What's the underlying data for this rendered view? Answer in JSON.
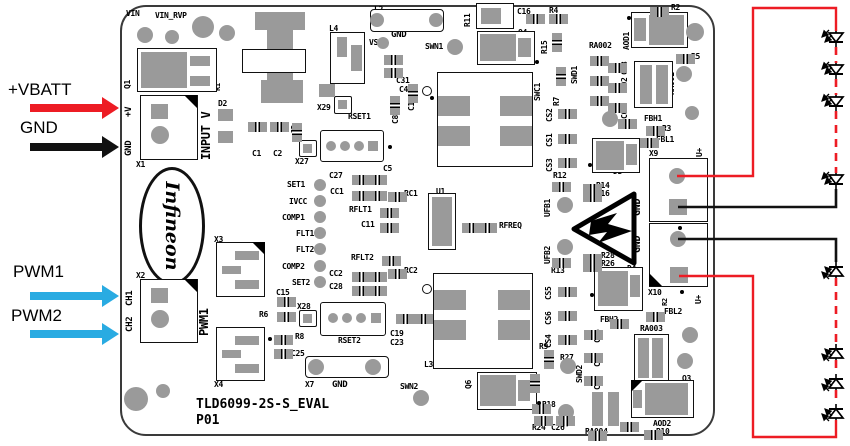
{
  "colors": {
    "supply_red": "#ed1c24",
    "return_black": "#111111",
    "pwm_blue": "#29abe2",
    "pad_gray": "#9a9a9a",
    "board_border": "#3a3a3a"
  },
  "inputs": {
    "vbatt_label": "+VBATT",
    "gnd_label": "GND",
    "pwm1_label": "PWM1",
    "pwm2_label": "PWM2"
  },
  "board": {
    "title": "TLD6099-2S-S_EVAL",
    "revision": "P01",
    "logo_text": "Infineon",
    "labels": [
      {
        "t": "VIN",
        "x": 126,
        "y": 10
      },
      {
        "t": "VIN_RVP",
        "x": 155,
        "y": 12
      },
      {
        "t": "L2",
        "x": 374,
        "y": 6
      },
      {
        "t": "X12",
        "x": 380,
        "y": 19
      },
      {
        "t": "GND",
        "x": 391,
        "y": 31,
        "s": 9
      },
      {
        "t": "VS",
        "x": 369,
        "y": 39
      },
      {
        "t": "SWN1",
        "x": 425,
        "y": 43
      },
      {
        "t": "R11",
        "x": 464,
        "y": 27,
        "v": 1
      },
      {
        "t": "C16",
        "x": 517,
        "y": 8
      },
      {
        "t": "R4",
        "x": 549,
        "y": 7
      },
      {
        "t": "Q4",
        "x": 518,
        "y": 29
      },
      {
        "t": "R15",
        "x": 541,
        "y": 54,
        "v": 1
      },
      {
        "t": "L4",
        "x": 329,
        "y": 25
      },
      {
        "t": "X29",
        "x": 317,
        "y": 104
      },
      {
        "t": "C31",
        "x": 396,
        "y": 77
      },
      {
        "t": "C4",
        "x": 399,
        "y": 86
      },
      {
        "t": "C13",
        "x": 408,
        "y": 111,
        "v": 1
      },
      {
        "t": "C8",
        "x": 392,
        "y": 124,
        "v": 1
      },
      {
        "t": "C3",
        "x": 291,
        "y": 134,
        "v": 1
      },
      {
        "t": "D2",
        "x": 218,
        "y": 100
      },
      {
        "t": "C1",
        "x": 252,
        "y": 150
      },
      {
        "t": "C2",
        "x": 273,
        "y": 150
      },
      {
        "t": "X27",
        "x": 295,
        "y": 158
      },
      {
        "t": "RSET1",
        "x": 348,
        "y": 113
      },
      {
        "t": "C5",
        "x": 383,
        "y": 165
      },
      {
        "t": "RA002",
        "x": 589,
        "y": 42
      },
      {
        "t": "SWD1",
        "x": 571,
        "y": 84,
        "v": 1
      },
      {
        "t": "SWC1",
        "x": 534,
        "y": 101,
        "v": 1
      },
      {
        "t": "R7",
        "x": 553,
        "y": 106,
        "v": 1
      },
      {
        "t": "R2",
        "x": 671,
        "y": 4
      },
      {
        "t": "AOD1",
        "x": 623,
        "y": 50,
        "v": 1
      },
      {
        "t": "R5",
        "x": 691,
        "y": 53
      },
      {
        "t": "RA001",
        "x": 668,
        "y": 95,
        "v": 1
      },
      {
        "t": "C03",
        "x": 621,
        "y": 75,
        "v": 1
      },
      {
        "t": "C02",
        "x": 621,
        "y": 91,
        "v": 1
      },
      {
        "t": "C01",
        "x": 621,
        "y": 119,
        "v": 1
      },
      {
        "t": "FBH1",
        "x": 644,
        "y": 115
      },
      {
        "t": "R3",
        "x": 662,
        "y": 125
      },
      {
        "t": "FBL1",
        "x": 656,
        "y": 136
      },
      {
        "t": "CS2",
        "x": 546,
        "y": 122,
        "v": 1
      },
      {
        "t": "CS1",
        "x": 546,
        "y": 147,
        "v": 1
      },
      {
        "t": "CS3",
        "x": 546,
        "y": 172,
        "v": 1
      },
      {
        "t": "L1",
        "x": 514,
        "y": 160
      },
      {
        "t": "R12",
        "x": 553,
        "y": 172
      },
      {
        "t": "R14",
        "x": 596,
        "y": 182
      },
      {
        "t": "R16",
        "x": 596,
        "y": 190
      },
      {
        "t": "UFB1",
        "x": 544,
        "y": 217,
        "v": 1
      },
      {
        "t": "UFB2",
        "x": 544,
        "y": 264,
        "v": 1
      },
      {
        "t": "R28",
        "x": 601,
        "y": 252
      },
      {
        "t": "R26",
        "x": 601,
        "y": 260
      },
      {
        "t": "R13",
        "x": 551,
        "y": 267
      },
      {
        "t": "D3",
        "x": 613,
        "y": 168
      },
      {
        "t": "D4",
        "x": 627,
        "y": 265
      },
      {
        "t": "X9",
        "x": 649,
        "y": 150
      },
      {
        "t": "U+",
        "x": 696,
        "y": 157,
        "v": 1
      },
      {
        "t": "GND",
        "x": 633,
        "y": 216,
        "v": 1,
        "s": 10
      },
      {
        "t": "GND",
        "x": 633,
        "y": 253,
        "v": 1,
        "s": 10
      },
      {
        "t": "X10",
        "x": 648,
        "y": 289
      },
      {
        "t": "R2",
        "x": 662,
        "y": 306,
        "v": 1,
        "s": 7
      },
      {
        "t": "U+",
        "x": 695,
        "y": 304,
        "v": 1
      },
      {
        "t": "SET1",
        "x": 287,
        "y": 181
      },
      {
        "t": "IVCC",
        "x": 289,
        "y": 198
      },
      {
        "t": "COMP1",
        "x": 282,
        "y": 214
      },
      {
        "t": "FLT1",
        "x": 296,
        "y": 230
      },
      {
        "t": "FLT2",
        "x": 296,
        "y": 246
      },
      {
        "t": "COMP2",
        "x": 282,
        "y": 263
      },
      {
        "t": "SET2",
        "x": 292,
        "y": 279
      },
      {
        "t": "C27",
        "x": 329,
        "y": 172
      },
      {
        "t": "CC1",
        "x": 330,
        "y": 188
      },
      {
        "t": "RFLT1",
        "x": 349,
        "y": 206
      },
      {
        "t": "C11",
        "x": 361,
        "y": 221
      },
      {
        "t": "RFLT2",
        "x": 351,
        "y": 254
      },
      {
        "t": "CC2",
        "x": 329,
        "y": 270
      },
      {
        "t": "C28",
        "x": 329,
        "y": 283
      },
      {
        "t": "RC1",
        "x": 404,
        "y": 190
      },
      {
        "t": "RC2",
        "x": 404,
        "y": 267
      },
      {
        "t": "U1",
        "x": 436,
        "y": 188
      },
      {
        "t": "RFREQ",
        "x": 499,
        "y": 222
      },
      {
        "t": "CS5",
        "x": 545,
        "y": 300,
        "v": 1
      },
      {
        "t": "CS6",
        "x": 545,
        "y": 325,
        "v": 1
      },
      {
        "t": "CS4",
        "x": 545,
        "y": 348,
        "v": 1
      },
      {
        "t": "FBH2",
        "x": 600,
        "y": 316
      },
      {
        "t": "RA003",
        "x": 640,
        "y": 325
      },
      {
        "t": "FBL2",
        "x": 664,
        "y": 308
      },
      {
        "t": "C06",
        "x": 594,
        "y": 343,
        "v": 1
      },
      {
        "t": "C05",
        "x": 594,
        "y": 367,
        "v": 1
      },
      {
        "t": "C04",
        "x": 594,
        "y": 390,
        "v": 1
      },
      {
        "t": "Q3",
        "x": 682,
        "y": 375
      },
      {
        "t": "AOD2",
        "x": 653,
        "y": 420
      },
      {
        "t": "R10",
        "x": 656,
        "y": 428
      },
      {
        "t": "RA004",
        "x": 585,
        "y": 428
      },
      {
        "t": "R9",
        "x": 539,
        "y": 343
      },
      {
        "t": "R27",
        "x": 560,
        "y": 354
      },
      {
        "t": "SWD2",
        "x": 576,
        "y": 383,
        "v": 1
      },
      {
        "t": "R18",
        "x": 542,
        "y": 401
      },
      {
        "t": "SWC2",
        "x": 562,
        "y": 427,
        "v": 1
      },
      {
        "t": "R24",
        "x": 532,
        "y": 424
      },
      {
        "t": "C26",
        "x": 551,
        "y": 424
      },
      {
        "t": "X3",
        "x": 214,
        "y": 236
      },
      {
        "t": "X4",
        "x": 214,
        "y": 381
      },
      {
        "t": "X2",
        "x": 136,
        "y": 272
      },
      {
        "t": "CH1",
        "x": 126,
        "y": 306,
        "v": 1,
        "s": 9
      },
      {
        "t": "CH2",
        "x": 126,
        "y": 332,
        "v": 1,
        "s": 9
      },
      {
        "t": "PWM1",
        "x": 198,
        "y": 336,
        "v": 1,
        "s": 12
      },
      {
        "t": "X1",
        "x": 136,
        "y": 161
      },
      {
        "t": "+V",
        "x": 125,
        "y": 117,
        "v": 1,
        "s": 9
      },
      {
        "t": "GND",
        "x": 125,
        "y": 156,
        "v": 1,
        "s": 9
      },
      {
        "t": "INPUT V",
        "x": 200,
        "y": 160,
        "v": 1,
        "s": 12
      },
      {
        "t": "Q1",
        "x": 124,
        "y": 89,
        "v": 1
      },
      {
        "t": "D1",
        "x": 206,
        "y": 74,
        "v": 1,
        "s": 7
      },
      {
        "t": "R1",
        "x": 215,
        "y": 91,
        "v": 1,
        "s": 7
      },
      {
        "t": "C15",
        "x": 276,
        "y": 289
      },
      {
        "t": "R6",
        "x": 259,
        "y": 311
      },
      {
        "t": "X28",
        "x": 297,
        "y": 303
      },
      {
        "t": "R8",
        "x": 295,
        "y": 333
      },
      {
        "t": "C25",
        "x": 291,
        "y": 350
      },
      {
        "t": "RSET2",
        "x": 338,
        "y": 337
      },
      {
        "t": "C19",
        "x": 390,
        "y": 330
      },
      {
        "t": "C23",
        "x": 390,
        "y": 339
      },
      {
        "t": "L3",
        "x": 424,
        "y": 361
      },
      {
        "t": "Q6",
        "x": 465,
        "y": 389,
        "v": 1
      },
      {
        "t": "SWN2",
        "x": 400,
        "y": 383
      },
      {
        "t": "X7",
        "x": 305,
        "y": 381
      },
      {
        "t": "GND",
        "x": 332,
        "y": 381,
        "s": 9
      }
    ]
  },
  "led_strings": {
    "top_visible_leds": 4,
    "bottom_visible_leds": 4,
    "supply_wire_color": "red",
    "return_wire_color": "black"
  }
}
